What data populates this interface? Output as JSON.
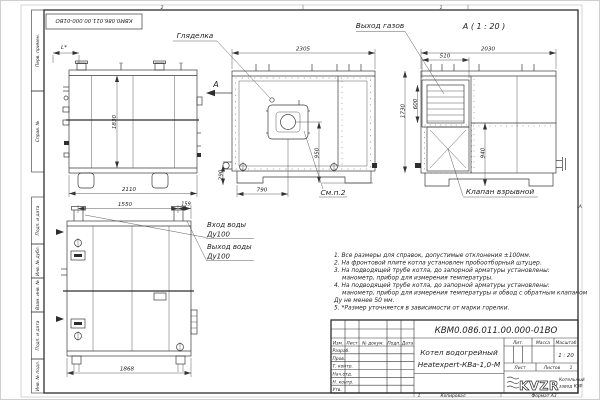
{
  "drawing": {
    "doc_number": "КВМ0.086.011.00.000-01ВО",
    "doc_number_top": "КВМ0.086.011.00.000-01ВО",
    "product_name_line1": "Котел водогрейный",
    "product_name_line2": "Heatexpert-КВа-1,0-М",
    "scale_value": "1 : 20"
  },
  "stamp": {
    "col_izm": "Изм.",
    "col_list": "Лист",
    "col_doc": "№ докум.",
    "col_podp": "Подп.",
    "col_data": "Дата",
    "row1": "Разраб.",
    "row2": "Пров.",
    "row3": "Т. контр.",
    "row4": "Нач.отд.",
    "row5": "Н. контр.",
    "row6": "Утв.",
    "lit_label": "Лит.",
    "mass_label": "Масса",
    "scale_label": "Масштаб",
    "sheet_label": "Лист",
    "sheets_label": "Листов",
    "sheets_value": "1",
    "copied_label": "Копировал",
    "format_label": "Формат А3",
    "zone_bottom": "1"
  },
  "logo": {
    "text": "KVZR",
    "caption_line1": "Котельный",
    "caption_line2": "завод КЗР"
  },
  "margin_labels": {
    "m1": "Перв. примен.",
    "m2": "Справ. №",
    "m3": "Подп. и дата",
    "m4": "Инв. № дубл.",
    "m5": "Взам. инв. №",
    "m6": "Подп. и дата",
    "m7": "Инв. № подл."
  },
  "zones": {
    "top_left": "2",
    "top_right": "1",
    "right": "А"
  },
  "notes": {
    "n1": "1. Все размеры для справок, допустимые отклонения ±100мм.",
    "n2": "2. На фронтовой плите котла установлен пробоотборный штуцер.",
    "n3": "3. На подводящей трубе котла, до запорной арматуры установлены:",
    "n3b": "манометр, прибор для измерения температуры.",
    "n4": "4. На подводящей трубе котла, до запорной арматуры установлены:",
    "n4b": "манометр, прибор для измерения температуры и обвод с обратным клапаном",
    "n4c": "Ду не менее 50 мм.",
    "n5": "5. *Размер уточняется в зависимости от марки горелки."
  },
  "labels": {
    "sight_glass": "Гляделка",
    "gas_outlet": "Выход газов",
    "view_a_caption": "А ( 1 : 20 )",
    "view_arrow": "А",
    "see_item": "См.п.2",
    "explosion_valve": "Клапан взрывной",
    "water_in": "Вход воды",
    "water_in_dn": "Ду100",
    "water_out": "Выход воды",
    "water_out_dn": "Ду100"
  },
  "dims": {
    "side_width": "2110",
    "side_height": "1830",
    "side_l": "L*",
    "front_width": "2305",
    "front_burner_h": "950",
    "front_burner_x": "790",
    "front_base": "290",
    "a_width": "2030",
    "a_outlet_w": "510",
    "a_outlet_h": "600",
    "a_height": "1730",
    "a_valve_h": "940",
    "rear_span": "1550",
    "rear_offset": "159",
    "rear_width": "1868"
  }
}
